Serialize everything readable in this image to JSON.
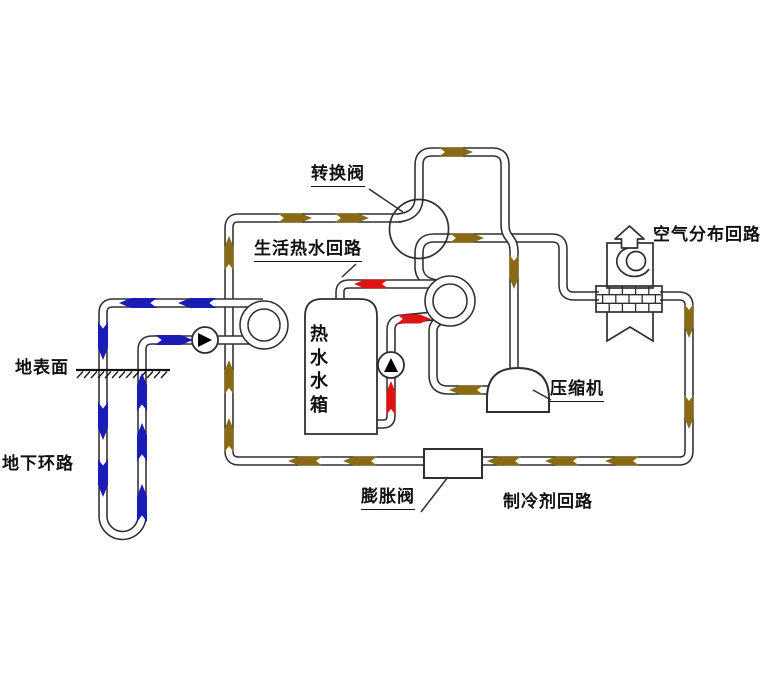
{
  "diagram": {
    "title": "ground-source-heat-pump-schematic",
    "labels": {
      "switch_valve": "转换阀",
      "dhw_loop": "生活热水回路",
      "air_distribution_loop": "空气分布回路",
      "hot_water_tank": "热水水箱",
      "ground_surface": "地表面",
      "underground_loop": "地下环路",
      "compressor": "压缩机",
      "expansion_valve": "膨胀阀",
      "refrigerant_loop": "制冷剂回路"
    },
    "colors": {
      "ground_loop_flow": "#1b1bb5",
      "refrigerant_flow": "#8a6a15",
      "hot_water_flow": "#de1414",
      "pipe_outline": "#2f2f2f",
      "pump_symbol": "#000000",
      "background": "#ffffff"
    },
    "icons": [
      "reversing-valve-icon",
      "circulation-pump-icon",
      "hot-water-pump-icon",
      "compressor-icon",
      "expansion-valve-icon",
      "hot-water-tank-icon",
      "air-handler-fan-icon",
      "air-outlet-arrow-icon",
      "heat-exchanger-brick-icon",
      "ground-surface-hatch-icon",
      "borehole-u-pipe-icon",
      "flow-arrow-icon"
    ]
  }
}
